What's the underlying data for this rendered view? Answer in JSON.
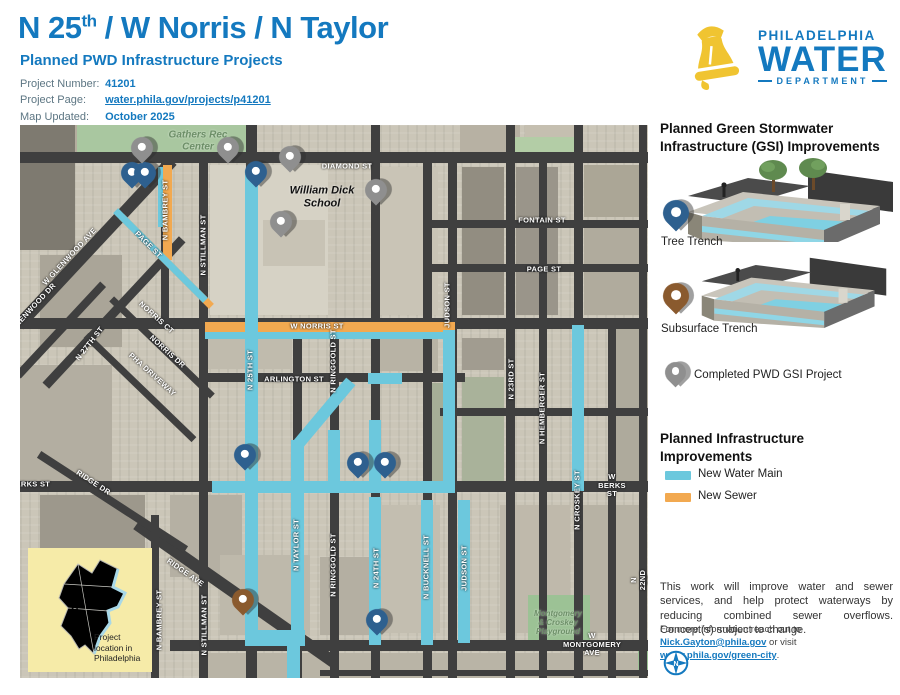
{
  "header": {
    "title_pre": "N 25",
    "title_sup": "th",
    "title_post": " / W Norris / N Taylor",
    "subtitle": "Planned PWD Infrastructure Projects",
    "info": [
      {
        "label": "Project Number:",
        "value": "41201"
      },
      {
        "label": "Project Page:",
        "value": "water.phila.gov/projects/p41201"
      },
      {
        "label": "Map Updated:",
        "value": "October 2025"
      }
    ]
  },
  "logo": {
    "line1": "PHILADELPHIA",
    "line2": "WATER",
    "line3": "DEPARTMENT"
  },
  "sidebar": {
    "gsi_heading": "Planned Green Stormwater Infrastructure (GSI) Improvements",
    "tree_trench_label": "Tree Trench",
    "subsurface_label": "Subsurface Trench",
    "completed_label": "Completed PWD GSI Project",
    "infra_heading": "Planned Infrastructure Improvements",
    "legend": [
      {
        "label": "New Water Main",
        "color": "#6cc8dd"
      },
      {
        "label": "New Sewer",
        "color": "#f2a950"
      }
    ],
    "note": "This work will improve water and sewer services, and help protect waterways by reducing combined sewer overflows. Concept(s) subject to change.",
    "contact_pre": "For more information reach out to ",
    "contact_email": "Nick.Gayton@phila.gov",
    "contact_mid": " or visit ",
    "contact_link": "water.phila.gov/green-city",
    "contact_end": ".",
    "compass_n": "N"
  },
  "inset": {
    "caption": "Project\nlocation in\nPhiladelphia",
    "star": "★"
  },
  "map": {
    "colors": {
      "water": "#6cc8dd",
      "sewer": "#f2a950",
      "street": "#3f3f3f"
    },
    "blocks": [
      {
        "x": 0,
        "y": 0,
        "w": 55,
        "h": 125,
        "c": "#7e7a70"
      },
      {
        "x": 55,
        "y": 0,
        "w": 55,
        "h": 30,
        "c": "#b4ad9e"
      },
      {
        "x": 110,
        "y": 0,
        "w": 78,
        "h": 28,
        "c": "#c2bcae"
      },
      {
        "x": 440,
        "y": 0,
        "w": 60,
        "h": 28,
        "c": "#b7b1a3"
      },
      {
        "x": 505,
        "y": 0,
        "w": 58,
        "h": 28,
        "c": "#c5bfb0"
      },
      {
        "x": 20,
        "y": 130,
        "w": 82,
        "h": 92,
        "c": "#aaa598"
      },
      {
        "x": 0,
        "y": 240,
        "w": 92,
        "h": 118,
        "c": "#b3aea1"
      },
      {
        "x": 190,
        "y": 40,
        "w": 118,
        "h": 150,
        "c": "#d6d2c5"
      },
      {
        "x": 243,
        "y": 95,
        "w": 62,
        "h": 46,
        "c": "#c8c3b5"
      },
      {
        "x": 442,
        "y": 42,
        "w": 42,
        "h": 148,
        "c": "#928d81"
      },
      {
        "x": 496,
        "y": 42,
        "w": 42,
        "h": 148,
        "c": "#9a958a"
      },
      {
        "x": 564,
        "y": 40,
        "w": 58,
        "h": 52,
        "c": "#aba696"
      },
      {
        "x": 564,
        "y": 100,
        "w": 58,
        "h": 90,
        "c": "#b0ab9d"
      },
      {
        "x": 442,
        "y": 213,
        "w": 42,
        "h": 32,
        "c": "#a19c90"
      },
      {
        "x": 358,
        "y": 42,
        "w": 60,
        "h": 148,
        "c": "#c9c4b6"
      },
      {
        "x": 358,
        "y": 210,
        "w": 60,
        "h": 36,
        "c": "#b8b3a5"
      },
      {
        "x": 188,
        "y": 214,
        "w": 84,
        "h": 30,
        "c": "#c0bbad"
      },
      {
        "x": 408,
        "y": 258,
        "w": 28,
        "h": 98,
        "c": "#a5ae97"
      },
      {
        "x": 442,
        "y": 252,
        "w": 42,
        "h": 106,
        "c": "#a9b29a"
      },
      {
        "x": 20,
        "y": 370,
        "w": 105,
        "h": 168,
        "c": "#9d988c"
      },
      {
        "x": 150,
        "y": 370,
        "w": 72,
        "h": 82,
        "c": "#b5b0a3"
      },
      {
        "x": 360,
        "y": 380,
        "w": 60,
        "h": 128,
        "c": "#c3beb0"
      },
      {
        "x": 480,
        "y": 380,
        "w": 70,
        "h": 128,
        "c": "#bfb9ab"
      },
      {
        "x": 560,
        "y": 380,
        "w": 62,
        "h": 128,
        "c": "#b7b2a4"
      },
      {
        "x": 200,
        "y": 430,
        "w": 90,
        "h": 80,
        "c": "#beb9ab"
      },
      {
        "x": 300,
        "y": 432,
        "w": 50,
        "h": 78,
        "c": "#b4afa2"
      },
      {
        "x": 590,
        "y": 200,
        "w": 38,
        "h": 158,
        "c": "#aeaa9c"
      },
      {
        "x": 180,
        "y": 528,
        "w": 448,
        "h": 25,
        "c": "#b9b4a6"
      }
    ],
    "parks": [
      {
        "x": 57,
        "y": 0,
        "w": 173,
        "h": 32,
        "c": "#a9c7a0"
      },
      {
        "x": 495,
        "y": 12,
        "w": 65,
        "h": 20,
        "c": "#b3cda6"
      },
      {
        "x": 508,
        "y": 470,
        "w": 62,
        "h": 46,
        "c": "#9cc295"
      },
      {
        "x": 618,
        "y": 518,
        "w": 10,
        "h": 30,
        "c": "#9cc295"
      }
    ],
    "diagStreets": [
      {
        "cx": 75,
        "cy": 118,
        "len": 225,
        "ang": -47,
        "w": 12
      },
      {
        "cx": 94,
        "cy": 187,
        "len": 200,
        "ang": -47,
        "w": 9
      },
      {
        "cx": 40,
        "cy": 205,
        "len": 125,
        "ang": -47,
        "w": 8
      },
      {
        "cx": 142,
        "cy": 222,
        "len": 140,
        "ang": 44,
        "w": 7
      },
      {
        "cx": 120,
        "cy": 262,
        "len": 150,
        "ang": 44,
        "w": 7
      },
      {
        "cx": 215,
        "cy": 468,
        "len": 240,
        "ang": 35,
        "w": 12
      },
      {
        "cx": 92,
        "cy": 377,
        "len": 175,
        "ang": 33,
        "w": 8
      }
    ],
    "streetsH": [
      {
        "y": 32,
        "x1": 0,
        "x2": 628,
        "w": 11
      },
      {
        "y": 99,
        "x1": 405,
        "x2": 628,
        "w": 8
      },
      {
        "y": 143,
        "x1": 405,
        "x2": 628,
        "w": 8
      },
      {
        "y": 198,
        "x1": 0,
        "x2": 628,
        "w": 11
      },
      {
        "y": 252,
        "x1": 183,
        "x2": 445,
        "w": 9
      },
      {
        "y": 287,
        "x1": 420,
        "x2": 628,
        "w": 8
      },
      {
        "y": 361,
        "x1": 0,
        "x2": 628,
        "w": 11
      },
      {
        "y": 520,
        "x1": 150,
        "x2": 628,
        "w": 11
      },
      {
        "y": 548,
        "x1": 300,
        "x2": 628,
        "w": 6
      }
    ],
    "streetsV": [
      {
        "x": 145,
        "y1": 32,
        "y2": 200,
        "w": 8
      },
      {
        "x": 135,
        "y1": 390,
        "y2": 553,
        "w": 8
      },
      {
        "x": 183,
        "y1": 32,
        "y2": 553,
        "w": 9
      },
      {
        "x": 231,
        "y1": 0,
        "y2": 553,
        "w": 11
      },
      {
        "x": 277,
        "y1": 198,
        "y2": 553,
        "w": 9
      },
      {
        "x": 314,
        "y1": 198,
        "y2": 553,
        "w": 9
      },
      {
        "x": 355,
        "y1": 0,
        "y2": 553,
        "w": 9
      },
      {
        "x": 407,
        "y1": 32,
        "y2": 553,
        "w": 9
      },
      {
        "x": 432,
        "y1": 32,
        "y2": 553,
        "w": 9
      },
      {
        "x": 490,
        "y1": 0,
        "y2": 553,
        "w": 9
      },
      {
        "x": 523,
        "y1": 32,
        "y2": 553,
        "w": 8
      },
      {
        "x": 558,
        "y1": 0,
        "y2": 553,
        "w": 9
      },
      {
        "x": 592,
        "y1": 198,
        "y2": 553,
        "w": 8
      },
      {
        "x": 623,
        "y1": 0,
        "y2": 553,
        "w": 8
      }
    ],
    "sewerRects": [
      {
        "x": 185,
        "y": 197,
        "w": 250,
        "h": 10
      },
      {
        "x": 143,
        "y": 40,
        "w": 9,
        "h": 95
      }
    ],
    "sewerDiags": [
      {
        "cx": 146,
        "cy": 136,
        "len": 127,
        "ang": 45,
        "w": 7
      }
    ],
    "waterRects": [
      {
        "x": 225,
        "y": 45,
        "w": 13,
        "h": 430
      },
      {
        "x": 225,
        "y": 470,
        "w": 13,
        "h": 45
      },
      {
        "x": 225,
        "y": 505,
        "w": 60,
        "h": 16
      },
      {
        "x": 267,
        "y": 515,
        "w": 13,
        "h": 38
      },
      {
        "x": 271,
        "y": 315,
        "w": 13,
        "h": 200
      },
      {
        "x": 348,
        "y": 248,
        "w": 34,
        "h": 11
      },
      {
        "x": 308,
        "y": 305,
        "w": 12,
        "h": 62
      },
      {
        "x": 349,
        "y": 295,
        "w": 12,
        "h": 71
      },
      {
        "x": 349,
        "y": 372,
        "w": 12,
        "h": 148
      },
      {
        "x": 401,
        "y": 375,
        "w": 12,
        "h": 145
      },
      {
        "x": 423,
        "y": 205,
        "w": 12,
        "h": 161
      },
      {
        "x": 438,
        "y": 375,
        "w": 12,
        "h": 143
      },
      {
        "x": 552,
        "y": 200,
        "w": 12,
        "h": 166
      },
      {
        "x": 192,
        "y": 356,
        "w": 243,
        "h": 12
      },
      {
        "x": 185,
        "y": 207,
        "w": 250,
        "h": 7
      },
      {
        "x": 138,
        "y": 42,
        "w": 5,
        "h": 60
      }
    ],
    "waterDiags": [
      {
        "cx": 303,
        "cy": 289,
        "len": 85,
        "ang": -50,
        "w": 12
      },
      {
        "cx": 140,
        "cy": 130,
        "len": 127,
        "ang": 45,
        "w": 7
      }
    ],
    "labels": [
      {
        "t": "DIAMOND ST",
        "x": 327,
        "y": 42,
        "r": 0,
        "k": "st"
      },
      {
        "t": "FONTAIN ST",
        "x": 522,
        "y": 96,
        "r": 0,
        "k": "st"
      },
      {
        "t": "PAGE ST",
        "x": 524,
        "y": 145,
        "r": 0,
        "k": "st"
      },
      {
        "t": "W NORRIS ST",
        "x": 297,
        "y": 202,
        "r": 0,
        "k": "st"
      },
      {
        "t": "ARLINGTON ST",
        "x": 274,
        "y": 255,
        "r": 0,
        "k": "st"
      },
      {
        "t": "W BERKS ST",
        "x": 592,
        "y": 361,
        "r": 0,
        "k": "st"
      },
      {
        "t": "BERKS ST",
        "x": 10,
        "y": 360,
        "r": 0,
        "k": "st"
      },
      {
        "t": "W MONTGOMERY AVE",
        "x": 572,
        "y": 520,
        "r": 0,
        "k": "st"
      },
      {
        "t": "N BAMBREY ST",
        "x": 146,
        "y": 85,
        "r": -90,
        "k": "st"
      },
      {
        "t": "N STILLMAN ST",
        "x": 184,
        "y": 120,
        "r": -90,
        "k": "st"
      },
      {
        "t": "N BAMBREY ST",
        "x": 140,
        "y": 495,
        "r": -90,
        "k": "st"
      },
      {
        "t": "N STILLMAN ST",
        "x": 185,
        "y": 500,
        "r": -90,
        "k": "st"
      },
      {
        "t": "N 25TH ST",
        "x": 231,
        "y": 245,
        "r": -90,
        "k": "st"
      },
      {
        "t": "N TAYLOR ST",
        "x": 277,
        "y": 420,
        "r": -90,
        "k": "st"
      },
      {
        "t": "N RINGGOLD ST",
        "x": 314,
        "y": 236,
        "r": -90,
        "k": "st"
      },
      {
        "t": "N RINGGOLD ST",
        "x": 314,
        "y": 440,
        "r": -90,
        "k": "st"
      },
      {
        "t": "N 24TH ST",
        "x": 357,
        "y": 443,
        "r": -90,
        "k": "st"
      },
      {
        "t": "N BUCKNELL ST",
        "x": 407,
        "y": 442,
        "r": -90,
        "k": "st"
      },
      {
        "t": "JUDSON ST",
        "x": 428,
        "y": 180,
        "r": -90,
        "k": "st"
      },
      {
        "t": "JUDSON ST",
        "x": 445,
        "y": 443,
        "r": -90,
        "k": "st"
      },
      {
        "t": "N 23RD ST",
        "x": 492,
        "y": 254,
        "r": -90,
        "k": "st"
      },
      {
        "t": "N HEMBERGER ST",
        "x": 523,
        "y": 283,
        "r": -90,
        "k": "st"
      },
      {
        "t": "N CROSKEY ST",
        "x": 558,
        "y": 375,
        "r": -90,
        "k": "st"
      },
      {
        "t": "N 22ND ST",
        "x": 623,
        "y": 455,
        "r": -90,
        "k": "st"
      },
      {
        "t": "W GLENWOOD AVE",
        "x": 50,
        "y": 132,
        "r": -47,
        "k": "st"
      },
      {
        "t": "GLENWOOD DR",
        "x": 14,
        "y": 182,
        "r": -47,
        "k": "st"
      },
      {
        "t": "N 27TH ST",
        "x": 70,
        "y": 219,
        "r": -52,
        "k": "st"
      },
      {
        "t": "NORRIS CT",
        "x": 136,
        "y": 193,
        "r": 42,
        "k": "st"
      },
      {
        "t": "NORRIS DR",
        "x": 147,
        "y": 227,
        "r": 42,
        "k": "st"
      },
      {
        "t": "PHA DRIVEWAY",
        "x": 132,
        "y": 250,
        "r": 42,
        "k": "st"
      },
      {
        "t": "RIDGE AVE",
        "x": 165,
        "y": 448,
        "r": 35,
        "k": "st"
      },
      {
        "t": "RIDGE DR",
        "x": 73,
        "y": 358,
        "r": 33,
        "k": "st"
      },
      {
        "t": "PAGE ST",
        "x": 128,
        "y": 120,
        "r": 45,
        "k": "st"
      },
      {
        "t": "Gathers Rec\nCenter",
        "x": 178,
        "y": 16,
        "r": 0,
        "k": "pg",
        "s": 10
      },
      {
        "t": "William Dick\nSchool",
        "x": 302,
        "y": 72,
        "r": 0,
        "k": "pd",
        "s": 11
      },
      {
        "t": "Montgomery\n& Croskey\nPlayground",
        "x": 538,
        "y": 498,
        "r": 0,
        "k": "pg",
        "s": 8
      }
    ],
    "pins": [
      {
        "x": 112,
        "y": 48,
        "c": "blue"
      },
      {
        "x": 125,
        "y": 48,
        "c": "blue"
      },
      {
        "x": 236,
        "y": 47,
        "c": "blue"
      },
      {
        "x": 225,
        "y": 330,
        "c": "blue"
      },
      {
        "x": 338,
        "y": 338,
        "c": "blue"
      },
      {
        "x": 365,
        "y": 338,
        "c": "blue"
      },
      {
        "x": 357,
        "y": 495,
        "c": "blue"
      },
      {
        "x": 122,
        "y": 23,
        "c": "gray"
      },
      {
        "x": 208,
        "y": 23,
        "c": "gray"
      },
      {
        "x": 270,
        "y": 32,
        "c": "gray"
      },
      {
        "x": 356,
        "y": 65,
        "c": "gray"
      },
      {
        "x": 261,
        "y": 97,
        "c": "gray"
      },
      {
        "x": 223,
        "y": 475,
        "c": "brown"
      }
    ]
  }
}
